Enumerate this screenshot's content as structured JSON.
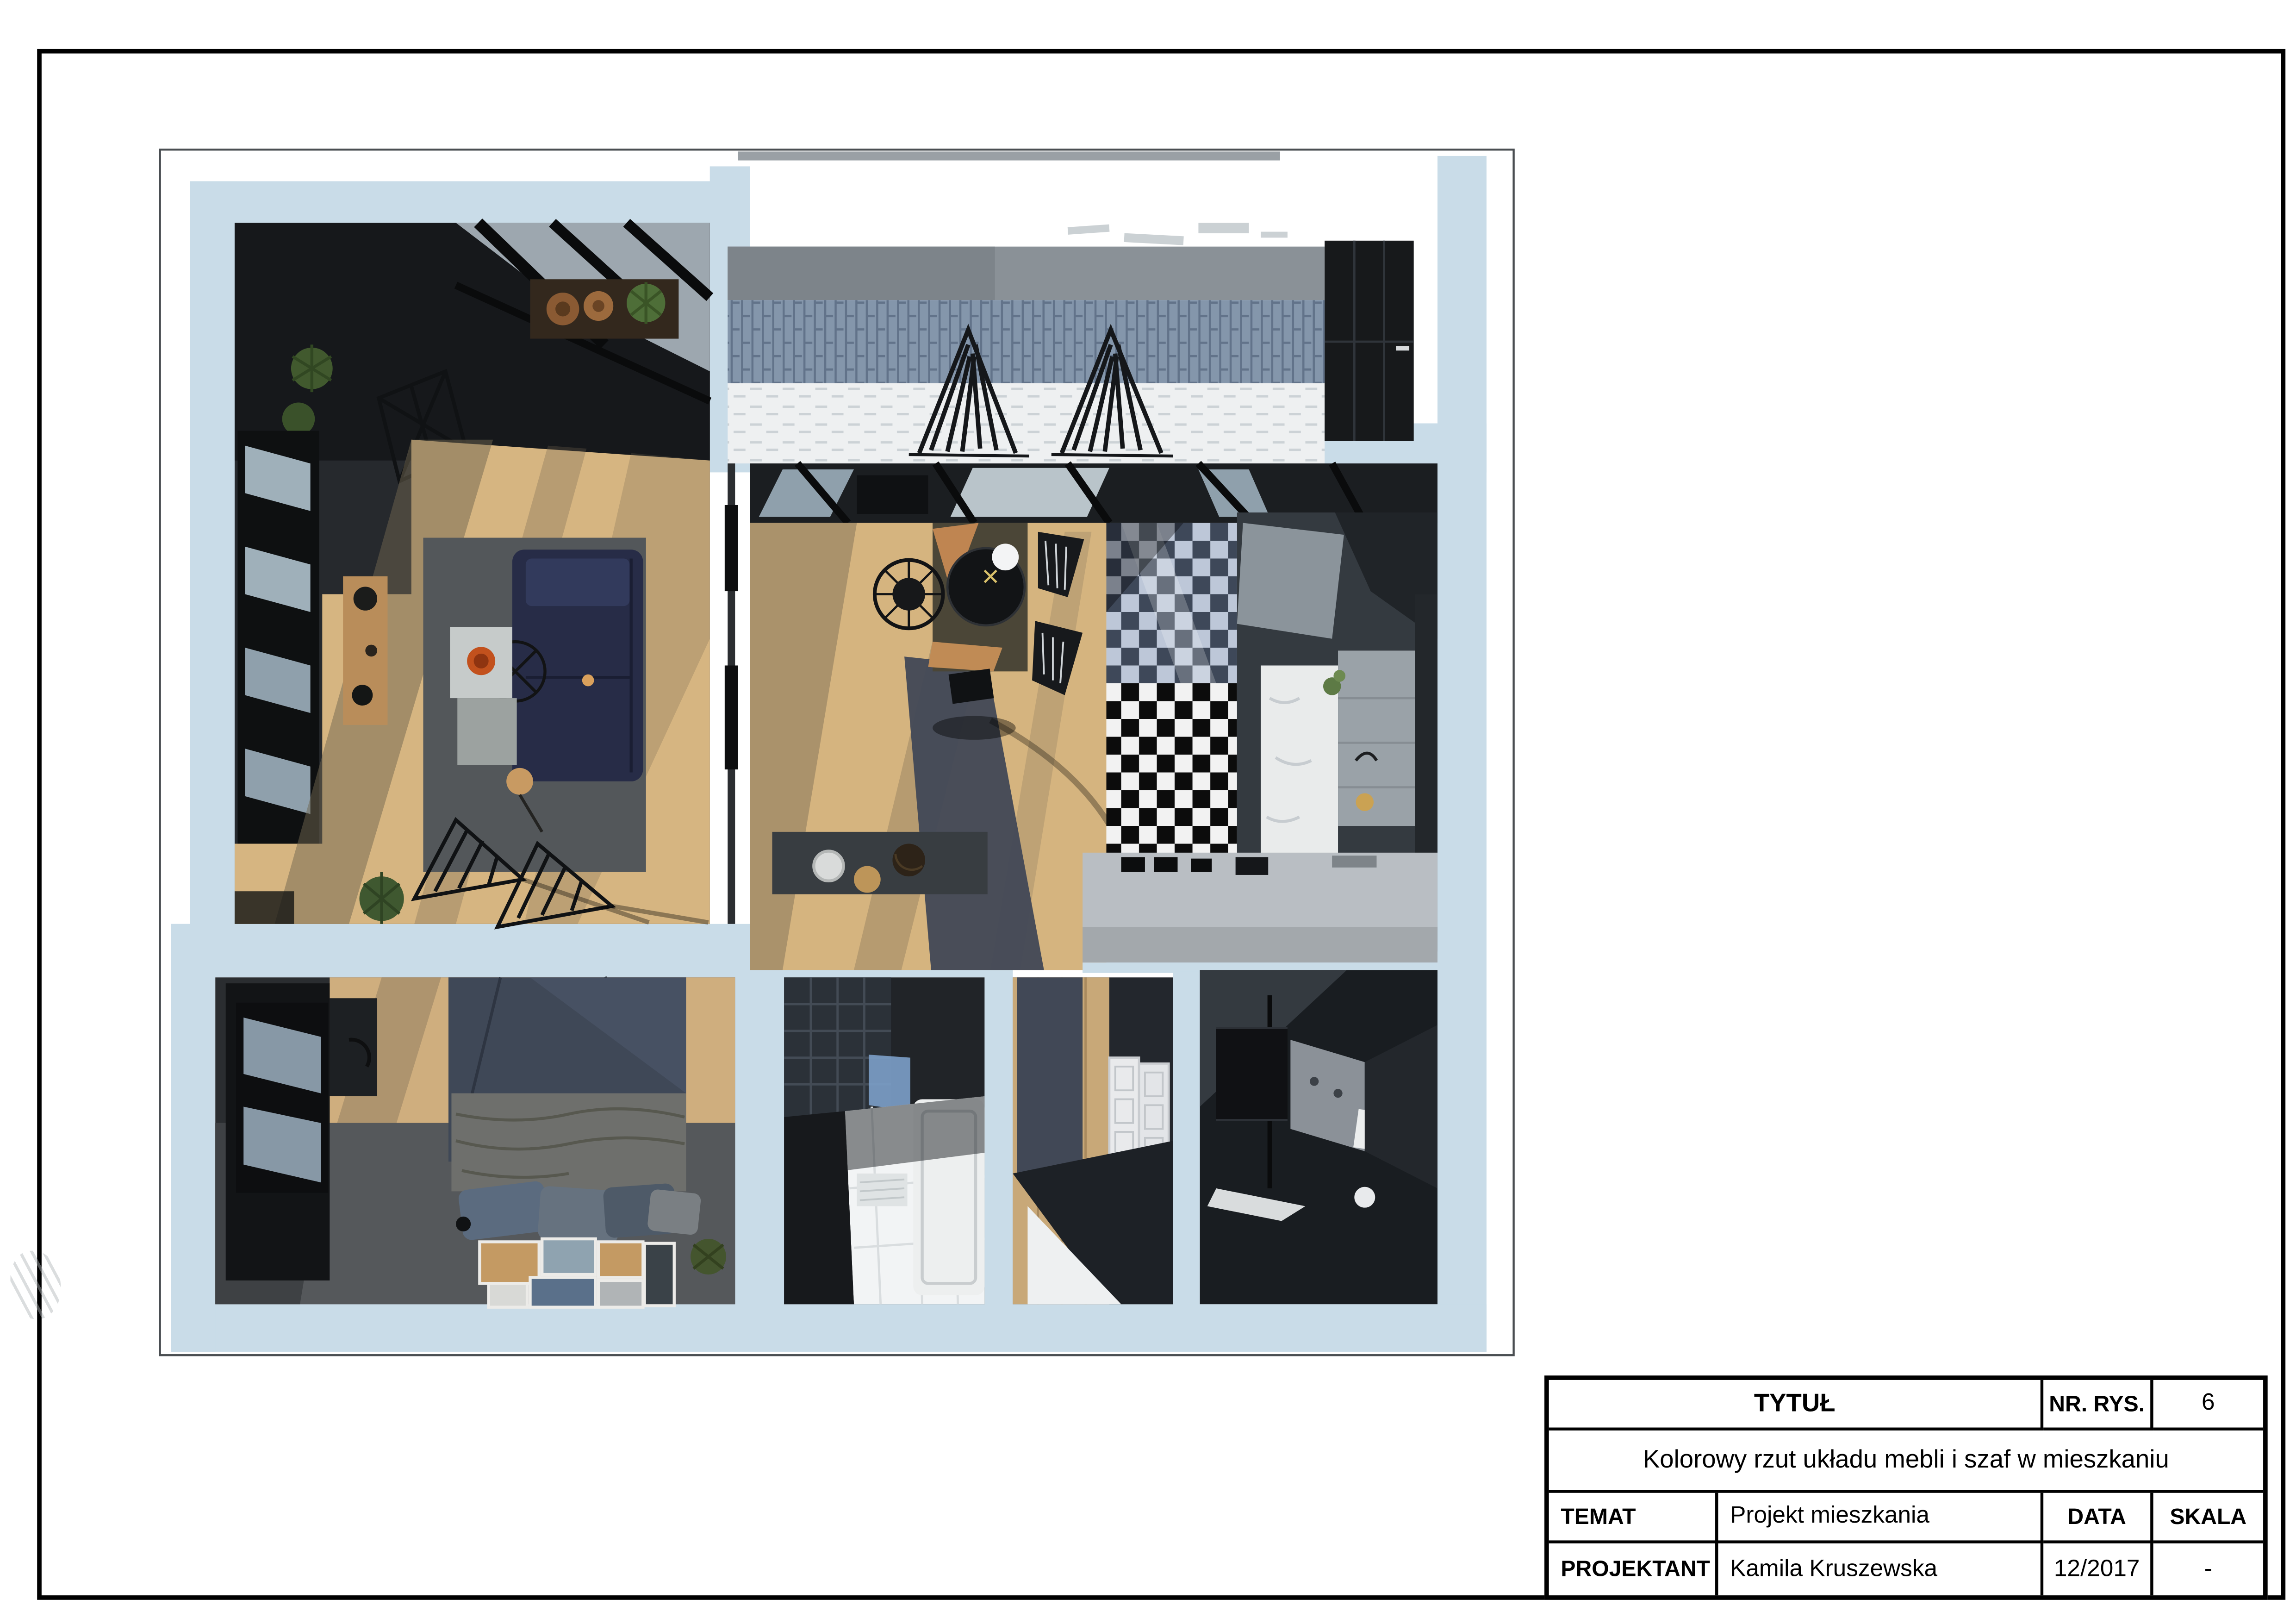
{
  "sheet": {
    "background": "#ffffff",
    "border_color": "#000000"
  },
  "title_block": {
    "row1": {
      "title_label": "TYTUŁ",
      "drawing_no_label": "NR. RYS.",
      "drawing_no_value": "6"
    },
    "row2": {
      "drawing_title": "Kolorowy rzut układu mebli i szaf w mieszkaniu"
    },
    "row3": {
      "subject_label": "TEMAT",
      "subject_value": "Projekt mieszkania",
      "date_label": "DATA",
      "scale_label": "SKALA"
    },
    "row4": {
      "designer_label": "PROJEKTANT",
      "designer_value": "Kamila Kruszewska",
      "date_value": "12/2017",
      "scale_value": "-"
    }
  },
  "floor_plan": {
    "type": "apartment-furniture-layout-3d-render",
    "rooms": [
      "living-room",
      "balcony-terrace",
      "dining-area",
      "kitchen",
      "bedroom",
      "bathroom",
      "hallway",
      "utility-room"
    ],
    "colors": {
      "wall_light_blue": "#c9dce8",
      "wood_floor": "#d5b47f",
      "dark_interior": "#222528",
      "sofa_navy": "#272c47",
      "checker_black": "#0c0c0c",
      "checker_white": "#f2f2f2",
      "balcony_tile_blue": "#8496ab",
      "counter_gray": "#b9bec3",
      "bowl_orange": "#c2511d"
    }
  }
}
